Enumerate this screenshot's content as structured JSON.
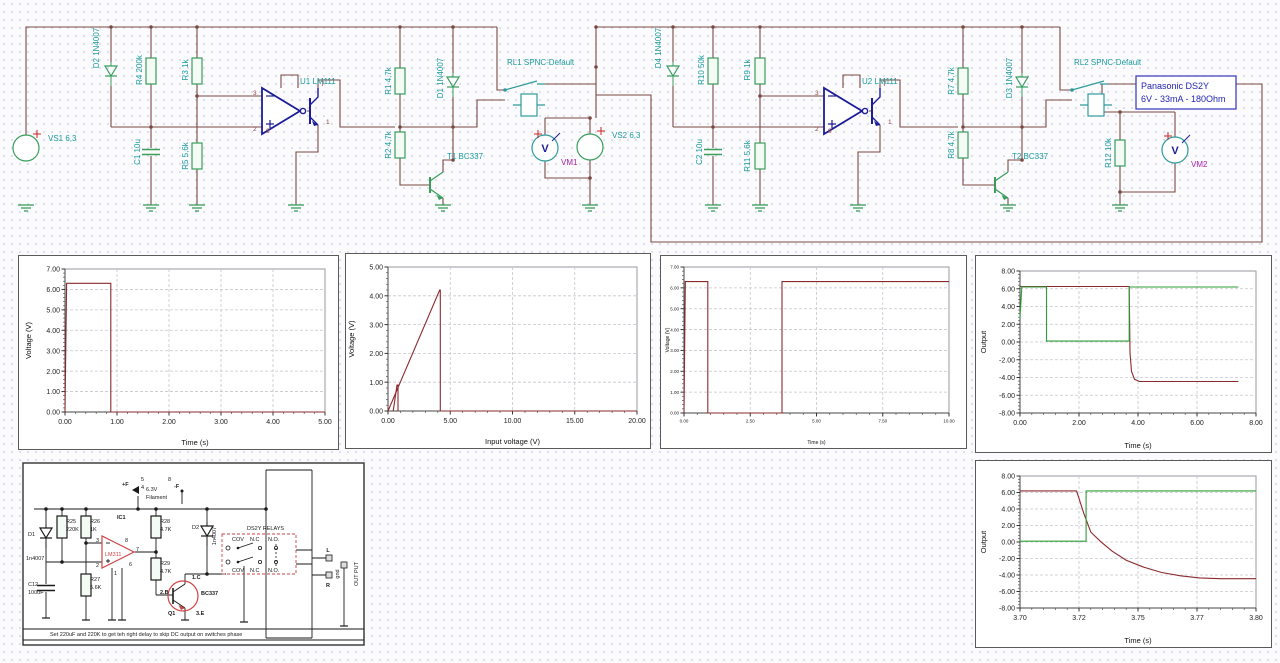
{
  "schematic": {
    "labels": {
      "vs1": "VS1 6,3",
      "d2": "D2 1N4007",
      "r4": "R4 200k",
      "c1": "C1 10u",
      "r3": "R3 1k",
      "r5": "R5 5,6k",
      "u1": "U1 LM111",
      "r1": "R1 4,7k",
      "r2": "R2 4,7k",
      "d1": "D1 1N4007",
      "t1": "T1 BC337",
      "rl1": "RL1 SPNC-Default",
      "vm1": "VM1",
      "vs2": "VS2 6,3",
      "d4": "D4 1N4007",
      "r10": "R10 50k",
      "c2": "C2 10u",
      "r9": "R9 1k",
      "r11": "R11 5,6k",
      "u2": "U2 LM111",
      "r7": "R7 4,7k",
      "r8": "R8 4,7k",
      "d3": "D3 1N4007",
      "t2": "T2 BC337",
      "rl2": "RL2 SPNC-Default",
      "r12": "R12 10k",
      "vm2": "VM2"
    },
    "pins": {
      "p3": "3",
      "p2": "2",
      "p7": "7",
      "p1": "1",
      "p8": "8"
    },
    "note_box": {
      "line1": "Panasonic DS2Y",
      "line2": "6V - 33mA - 180Ohm"
    }
  },
  "module": {
    "plus_f": "+F",
    "pin5": "5",
    "pin4": "4",
    "filament_voltage": "6.3V",
    "filament": "Filament",
    "pin8": "8",
    "minus_f": "-F",
    "d1": "D1",
    "d1_value": "1n4007",
    "r25": "R25",
    "r25_value": "220K",
    "r26": "R26",
    "r26_value": "1K",
    "ic1": "IC1",
    "ic1_value": "LM311",
    "pin3": "3",
    "pin2": "2",
    "pin8b": "8",
    "pin7": "7",
    "pin6": "6",
    "pin1": "1",
    "c12": "C12",
    "c12_value": "100uF",
    "r27": "R27",
    "r27_value": "5.6K",
    "r28": "R28",
    "r28_value": "4.7K",
    "r29": "R29",
    "r29_value": "4.7K",
    "d2": "D2",
    "d2_value": "1n4007",
    "q1": "Q1",
    "q1_value": "BC337",
    "q1_collector": "1.C",
    "q1_base": "2.B",
    "q1_emitter": "3.E",
    "relays_title": "DS2Y RELAYS",
    "cov_top": "COV",
    "nc_top": "N.C",
    "no_top": "N.O.",
    "cov_bottom": "COV",
    "nc_bottom": "N.C",
    "no_bottom": "N.O.",
    "out_l": "L",
    "out_r": "R",
    "gnd": "gnd",
    "out_label": "OUT PUT",
    "caption": "Set 220uF and 220K to get teh right delay to skip DC output on switches phase"
  },
  "chart_data": [
    {
      "type": "line",
      "title": "",
      "xlabel": "Time (s)",
      "ylabel": "Voltage (V)",
      "xlim": [
        0,
        5
      ],
      "ylim": [
        0,
        7
      ],
      "grid": true,
      "legend": "none",
      "xticks": [
        0,
        1,
        2,
        3,
        4,
        5
      ],
      "xtick_labels": [
        "0.00",
        "1.00",
        "2.00",
        "3.00",
        "4.00",
        "5.00"
      ],
      "yticks": [
        0,
        1,
        2,
        3,
        4,
        5,
        6,
        7
      ],
      "ytick_labels": [
        "0.00",
        "1.00",
        "2.00",
        "3.00",
        "4.00",
        "5.00",
        "6.00",
        "7.00"
      ],
      "series": [
        {
          "name": "source pulse",
          "color": "#8b2a2e",
          "points": [
            [
              0,
              0
            ],
            [
              0.03,
              6.3
            ],
            [
              0.88,
              6.3
            ],
            [
              0.88,
              0
            ],
            [
              5,
              0
            ]
          ]
        }
      ]
    },
    {
      "type": "line",
      "title": "",
      "xlabel": "Input voltage (V)",
      "ylabel": "Voltage (V)",
      "xlim": [
        0,
        20
      ],
      "ylim": [
        0,
        5
      ],
      "grid": true,
      "legend": "none",
      "xticks": [
        0,
        5,
        10,
        15,
        20
      ],
      "xtick_labels": [
        "0.00",
        "5.00",
        "10.00",
        "15.00",
        "20.00"
      ],
      "yticks": [
        0,
        1,
        2,
        3,
        4,
        5
      ],
      "ytick_labels": [
        "0.00",
        "1.00",
        "2.00",
        "3.00",
        "4.00",
        "5.00"
      ],
      "series": [
        {
          "name": "transfer ramp",
          "color": "#8b2a2e",
          "points": [
            [
              0,
              0
            ],
            [
              4.15,
              4.2
            ],
            [
              4.2,
              4.2
            ],
            [
              4.2,
              0
            ],
            [
              20,
              0
            ]
          ]
        },
        {
          "name": "switch spike",
          "color": "#8b2a2e",
          "points": [
            [
              0.42,
              0
            ],
            [
              0.72,
              0.9
            ],
            [
              0.8,
              0.9
            ],
            [
              0.8,
              0
            ]
          ]
        }
      ]
    },
    {
      "type": "line",
      "title": "",
      "xlabel": "Time (s)",
      "ylabel": "Voltage (V)",
      "xlim": [
        0,
        10
      ],
      "ylim": [
        0,
        7
      ],
      "grid": true,
      "legend": "none",
      "xticks": [
        0,
        2.5,
        5,
        7.5,
        10
      ],
      "xtick_labels": [
        "0.00",
        "2.50",
        "5.00",
        "7.50",
        "10.00"
      ],
      "yticks": [
        0,
        1,
        2,
        3,
        4,
        5,
        6,
        7
      ],
      "ytick_labels": [
        "0.00",
        "1.00",
        "2.00",
        "3.00",
        "4.00",
        "5.00",
        "6.00",
        "7.00"
      ],
      "series": [
        {
          "name": "relay voltage",
          "color": "#8b2a2e",
          "points": [
            [
              0,
              0
            ],
            [
              0.05,
              6.3
            ],
            [
              0.9,
              6.3
            ],
            [
              0.9,
              0
            ],
            [
              3.7,
              0
            ],
            [
              3.7,
              6.3
            ],
            [
              10,
              6.3
            ]
          ]
        }
      ]
    },
    {
      "type": "line",
      "title": "",
      "xlabel": "Time (s)",
      "ylabel": "Output",
      "xlim": [
        0,
        8
      ],
      "ylim": [
        -8,
        8
      ],
      "grid": true,
      "legend": "none",
      "xticks": [
        0,
        2,
        4,
        6,
        8
      ],
      "xtick_labels": [
        "0.00",
        "2.00",
        "4.00",
        "6.00",
        "8.00"
      ],
      "yticks": [
        -8,
        -6,
        -4,
        -2,
        0,
        2,
        4,
        6,
        8
      ],
      "ytick_labels": [
        "-8.00",
        "-6.00",
        "-4.00",
        "-2.00",
        "0.00",
        "2.00",
        "4.00",
        "6.00",
        "8.00"
      ],
      "series": [
        {
          "name": "VM2",
          "color": "#8b2a2e",
          "points": [
            [
              0,
              6.25
            ],
            [
              3.7,
              6.25
            ],
            [
              3.73,
              -1.2
            ],
            [
              3.78,
              -3.3
            ],
            [
              3.88,
              -4.2
            ],
            [
              4.05,
              -4.45
            ],
            [
              7.4,
              -4.45
            ]
          ]
        },
        {
          "name": "VM1",
          "color": "#2e9e39",
          "points": [
            [
              0,
              2.7
            ],
            [
              0.06,
              6.2
            ],
            [
              0.9,
              6.2
            ],
            [
              0.9,
              0.1
            ],
            [
              3.7,
              0.1
            ],
            [
              3.7,
              6.2
            ],
            [
              7.4,
              6.2
            ]
          ]
        }
      ]
    },
    {
      "type": "line",
      "title": "",
      "xlabel": "Time (s)",
      "ylabel": "Output",
      "xlim": [
        3.7,
        3.8
      ],
      "ylim": [
        -8,
        8
      ],
      "grid": true,
      "legend": "none",
      "xticks": [
        3.7,
        3.725,
        3.75,
        3.775,
        3.8
      ],
      "xtick_labels": [
        "3.70",
        "3.72",
        "3.75",
        "3.77",
        "3.80"
      ],
      "yticks": [
        -8,
        -6,
        -4,
        -2,
        0,
        2,
        4,
        6,
        8
      ],
      "ytick_labels": [
        "-8.00",
        "-6.00",
        "-4.00",
        "-2.00",
        "0.00",
        "2.00",
        "4.00",
        "6.00",
        "8.00"
      ],
      "series": [
        {
          "name": "VM2",
          "color": "#8b2a2e",
          "points": [
            [
              3.7,
              6.2
            ],
            [
              3.724,
              6.2
            ],
            [
              3.727,
              3.5
            ],
            [
              3.73,
              1.2
            ],
            [
              3.734,
              0.1
            ],
            [
              3.739,
              -1.1
            ],
            [
              3.745,
              -2.2
            ],
            [
              3.752,
              -3.0
            ],
            [
              3.76,
              -3.7
            ],
            [
              3.768,
              -4.1
            ],
            [
              3.776,
              -4.35
            ],
            [
              3.785,
              -4.45
            ],
            [
              3.8,
              -4.45
            ]
          ]
        },
        {
          "name": "VM1",
          "color": "#2e9e39",
          "points": [
            [
              3.7,
              0.1
            ],
            [
              3.728,
              0.1
            ],
            [
              3.728,
              6.2
            ],
            [
              3.8,
              6.2
            ]
          ]
        }
      ]
    }
  ]
}
